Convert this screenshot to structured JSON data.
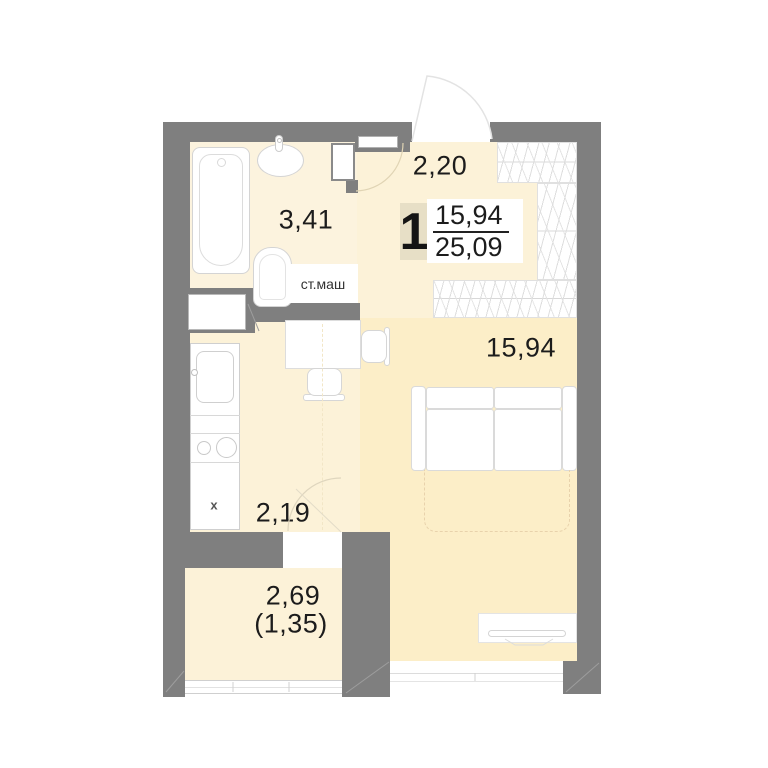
{
  "plan": {
    "apartment_number": "1",
    "area_room": "15,94",
    "area_total": "25,09",
    "labels": {
      "hall": "2,20",
      "bathroom": "3,41",
      "living_room": "15,94",
      "kitchen": "2,19",
      "balcony": "2,69",
      "balcony_reduced": "(1,35)",
      "washing_machine": "ст.маш",
      "fridge_marker": "x"
    },
    "colors": {
      "wall": "#7f7f7f",
      "floor_light": "#fcf2d8",
      "floor_living": "#fceec8",
      "badge_background": "#e7dfc6",
      "text": "#1c1c1c"
    }
  }
}
